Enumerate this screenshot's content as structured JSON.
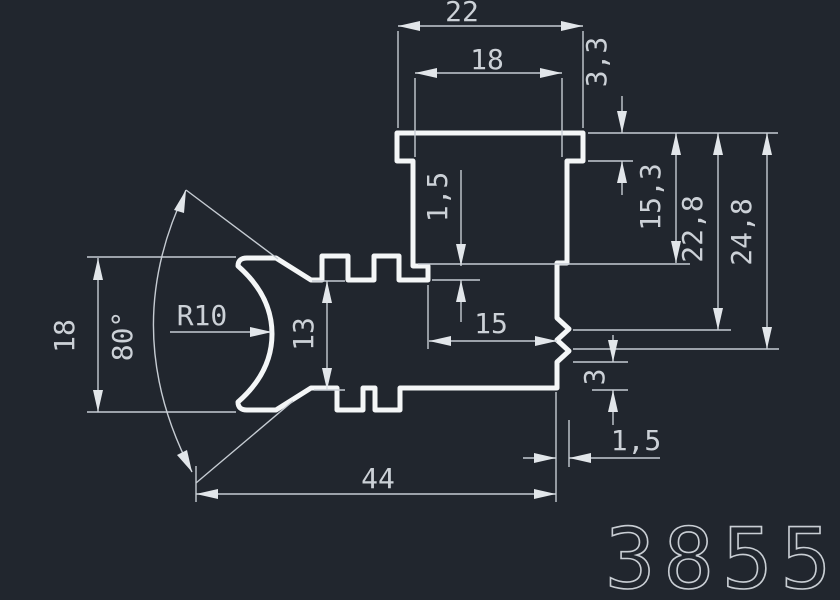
{
  "drawing": {
    "type": "extrusion-profile-cross-section",
    "part_number": "3855",
    "colors": {
      "background": "#21262e",
      "profile_line": "#f4f6f7",
      "dimension_line": "#c6ccd3",
      "dimension_text": "#ccd1d7",
      "part_number_text": "#c9ced4"
    }
  },
  "dimensions": {
    "top_flange_width": "22",
    "top_stem_width": "18",
    "flange_thickness": "3,3",
    "depth_to_ledge": "15,3",
    "depth_to_notch1": "22,8",
    "depth_to_notch2": "24,8",
    "channel_mouth_width": "15",
    "ledge_step": "1,5",
    "arm_thickness": "13",
    "crescent_height": "18",
    "opening_angle": "80°",
    "crescent_radius": "R10",
    "foot_height": "3",
    "foot_offset": "1,5",
    "overall_width": "44"
  }
}
